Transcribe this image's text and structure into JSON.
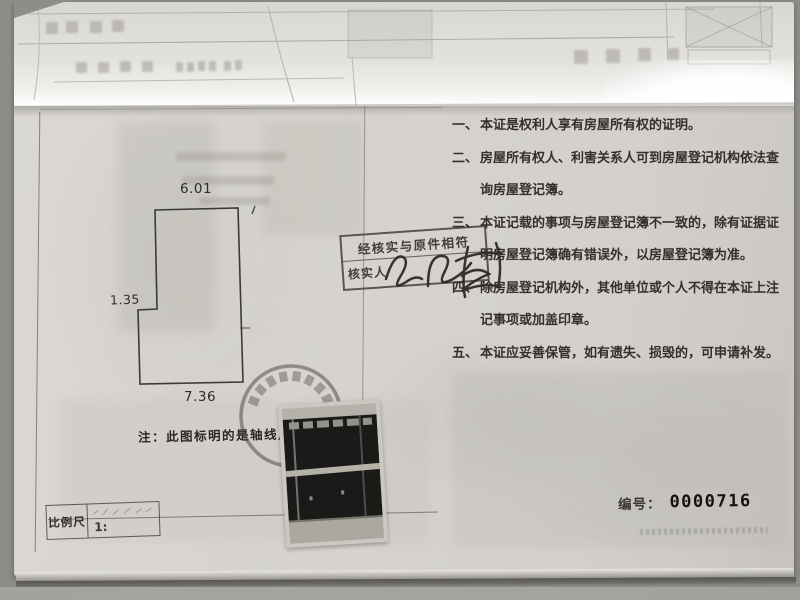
{
  "colors": {
    "paper": "#d6d3ce",
    "ink": "#332f2b",
    "stamp_ink": "#3a322c",
    "serial_ink": "#14110e",
    "background": "#8e8d8a"
  },
  "floor_plan": {
    "dim_top": "6.01",
    "dim_right": "14.48",
    "dim_left_step": "1.35",
    "dim_bottom": "7.36",
    "note": "注：此图标明的是轴线尺寸",
    "scale_label": "比例尺",
    "scale_value": "1:"
  },
  "verification_stamp": {
    "line1": "经核实与原件相符",
    "verifier_label": "核实人"
  },
  "terms": [
    {
      "num": "一、",
      "text": "本证是权利人享有房屋所有权的证明。"
    },
    {
      "num": "二、",
      "text": "房屋所有权人、利害关系人可到房屋登记机构依法查询房屋登记簿。"
    },
    {
      "num": "三、",
      "text": "本证记载的事项与房屋登记簿不一致的，除有证据证明房屋登记簿确有错误外，以房屋登记簿为准。"
    },
    {
      "num": "四、",
      "text": "除房屋登记机构外，其他单位或个人不得在本证上注记事项或加盖印章。"
    },
    {
      "num": "五、",
      "text": "本证应妥善保管，如有遗失、损毁的，可申请补发。"
    }
  ],
  "serial": {
    "label": "编号：",
    "number": "0000716"
  }
}
